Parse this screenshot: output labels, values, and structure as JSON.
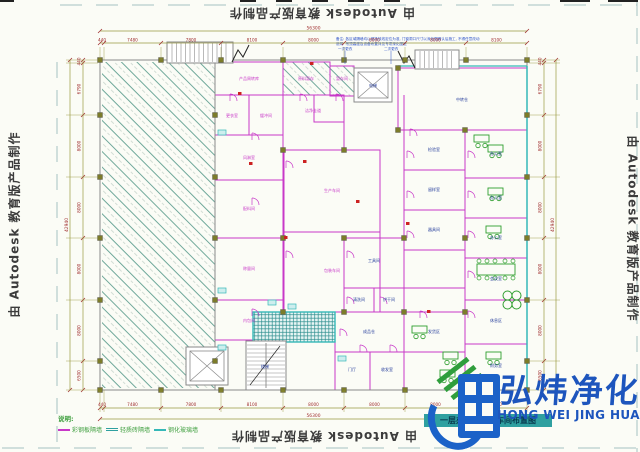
{
  "watermark": {
    "text": "由 Autodesk 教育版产品制作"
  },
  "legend": {
    "title": "说明:",
    "items": [
      "彩钢板隔墙",
      "轻质砖隔墙",
      "钢化玻璃墙"
    ]
  },
  "title_bar": {
    "text": "一层办公及生产车间布置图"
  },
  "logo": {
    "cn": "弘炜净化",
    "en": "HONG WEI JING HUA"
  },
  "note": {
    "lines": [
      "备注: 各区域隔墙均以现场放线定位为准, 门窗洞口尺寸以深化图确认后施工, 不得任意改动",
      "说明: 吊顶高度及设备布置详见专项深化图纸"
    ],
    "callouts": [
      {
        "t": "一次更衣",
        "x": 338,
        "y": 50
      },
      {
        "t": "二次更衣",
        "x": 384,
        "y": 50
      }
    ]
  },
  "dims": {
    "xticks": [
      100,
      104,
      161,
      221,
      283,
      344,
      405,
      466,
      527
    ],
    "yticks": [
      60,
      63,
      115,
      177,
      238,
      300,
      361,
      390
    ],
    "top": {
      "total": "56300",
      "labels": [
        "440",
        "7480",
        "7800",
        "8100",
        "8000",
        "8000",
        "8000",
        "8100"
      ]
    },
    "bottom": {
      "total": "56300",
      "labels": [
        "440",
        "7480",
        "7800",
        "8100",
        "8000",
        "8000",
        "8000",
        "8100"
      ]
    },
    "left": {
      "total": "42940",
      "labels": [
        "440",
        "6790",
        "8000",
        "8000",
        "8000",
        "8000",
        "6500"
      ]
    },
    "right": {
      "total": "42940",
      "labels": [
        "440",
        "6790",
        "8000",
        "8000",
        "8000",
        "8000",
        "6500"
      ]
    }
  },
  "plan": {
    "outline": [
      100,
      60,
      427,
      330
    ],
    "hall_hatch": [
      102,
      62,
      113,
      326
    ],
    "rooms": [
      [
        215,
        62,
        68,
        33,
        "m",
        ""
      ],
      [
        215,
        95,
        34,
        40,
        "m",
        ""
      ],
      [
        249,
        95,
        34,
        40,
        "m",
        ""
      ],
      [
        215,
        135,
        68,
        45,
        "m",
        ""
      ],
      [
        215,
        180,
        68,
        58,
        "m",
        ""
      ],
      [
        215,
        238,
        68,
        62,
        "m",
        ""
      ],
      [
        215,
        300,
        68,
        40,
        "m",
        ""
      ],
      [
        283,
        62,
        47,
        33,
        "m",
        "h"
      ],
      [
        330,
        66,
        24,
        30,
        "m",
        "h"
      ],
      [
        283,
        95,
        61,
        55,
        "m",
        ""
      ],
      [
        314,
        95,
        30,
        27,
        "m",
        ""
      ],
      [
        284,
        150,
        96,
        82,
        "m",
        ""
      ],
      [
        284,
        232,
        96,
        80,
        "m",
        ""
      ],
      [
        398,
        68,
        129,
        62,
        "m",
        ""
      ],
      [
        344,
        238,
        60,
        50,
        "m",
        ""
      ],
      [
        344,
        288,
        30,
        24,
        "m",
        ""
      ],
      [
        374,
        288,
        30,
        24,
        "m",
        ""
      ],
      [
        404,
        130,
        61,
        40,
        "m",
        ""
      ],
      [
        404,
        170,
        61,
        40,
        "m",
        ""
      ],
      [
        404,
        210,
        61,
        40,
        "m",
        ""
      ],
      [
        404,
        250,
        61,
        38,
        "m",
        ""
      ],
      [
        465,
        130,
        62,
        48,
        "m",
        ""
      ],
      [
        465,
        178,
        62,
        40,
        "m",
        ""
      ],
      [
        465,
        218,
        62,
        40,
        "m",
        ""
      ],
      [
        465,
        258,
        62,
        42,
        "m",
        ""
      ],
      [
        465,
        300,
        62,
        44,
        "m",
        ""
      ],
      [
        465,
        344,
        62,
        46,
        "m",
        ""
      ],
      [
        335,
        312,
        69,
        40,
        "m",
        ""
      ],
      [
        335,
        352,
        35,
        38,
        "m",
        ""
      ],
      [
        370,
        352,
        34,
        38,
        "m",
        ""
      ],
      [
        404,
        312,
        61,
        40,
        "m",
        ""
      ],
      [
        404,
        352,
        61,
        38,
        "m",
        ""
      ],
      [
        253,
        312,
        82,
        30,
        "c",
        "x"
      ]
    ],
    "lines": [
      [
        100,
        60,
        527,
        60,
        "g",
        1
      ],
      [
        100,
        390,
        527,
        390,
        "g",
        1
      ],
      [
        100,
        60,
        100,
        390,
        "g",
        1
      ],
      [
        215,
        60,
        215,
        390,
        "g",
        1
      ],
      [
        527,
        66,
        527,
        390,
        "c",
        1.5
      ],
      [
        398,
        66,
        527,
        66,
        "c",
        1.2
      ],
      [
        283,
        62,
        283,
        95,
        "m",
        1
      ],
      [
        283,
        95,
        283,
        150,
        "m",
        1
      ],
      [
        380,
        150,
        380,
        312,
        "m",
        1
      ],
      [
        404,
        95,
        404,
        130,
        "m",
        1
      ],
      [
        404,
        288,
        404,
        312,
        "m",
        1
      ]
    ],
    "labels": [
      [
        "产品周转库",
        249,
        80,
        "m"
      ],
      [
        "原料暂存",
        306,
        80,
        "m"
      ],
      [
        "暂存间",
        342,
        80,
        "m"
      ],
      [
        "中转仓",
        462,
        101,
        "n"
      ],
      [
        "更衣室",
        232,
        117,
        "m"
      ],
      [
        "缓冲间",
        266,
        117,
        "m"
      ],
      [
        "风淋室",
        249,
        159,
        "m"
      ],
      [
        "洁净走道",
        313,
        112,
        "m"
      ],
      [
        "配料间",
        249,
        210,
        "m"
      ],
      [
        "生产车间",
        332,
        192,
        "m"
      ],
      [
        "包装车间",
        332,
        272,
        "m"
      ],
      [
        "称量间",
        249,
        270,
        "m"
      ],
      [
        "内包间",
        249,
        322,
        "m"
      ],
      [
        "检验室",
        434,
        151,
        "n"
      ],
      [
        "留样室",
        434,
        191,
        "n"
      ],
      [
        "器具间",
        434,
        231,
        "n"
      ],
      [
        "工具间",
        374,
        262,
        "n"
      ],
      [
        "清洗间",
        359,
        301,
        "n"
      ],
      [
        "烘干间",
        389,
        301,
        "n"
      ],
      [
        "办公室",
        496,
        155,
        "n"
      ],
      [
        "办公室",
        496,
        199,
        "n"
      ],
      [
        "办公室",
        496,
        239,
        "n"
      ],
      [
        "会议室",
        496,
        280,
        "n"
      ],
      [
        "休息区",
        496,
        322,
        "n"
      ],
      [
        "财务室",
        496,
        367,
        "n"
      ],
      [
        "成品仓",
        369,
        333,
        "n"
      ],
      [
        "发货区",
        434,
        333,
        "n"
      ],
      [
        "门厅",
        352,
        371,
        "n"
      ],
      [
        "收发室",
        387,
        371,
        "n"
      ],
      [
        "电梯",
        373,
        87,
        "n"
      ],
      [
        "楼梯",
        265,
        368,
        "n"
      ]
    ],
    "stairs": {
      "a": [
        167,
        42,
        66,
        21
      ],
      "b": [
        415,
        50,
        44,
        19
      ],
      "c": [
        246,
        341,
        40,
        49
      ]
    },
    "elevators": [
      [
        354,
        68,
        38,
        34
      ],
      [
        186,
        347,
        42,
        38
      ]
    ],
    "columns_extra": [
      [
        283,
        150
      ],
      [
        344,
        150
      ],
      [
        283,
        238
      ],
      [
        344,
        238
      ],
      [
        283,
        312
      ],
      [
        344,
        312
      ],
      [
        404,
        238
      ],
      [
        404,
        312
      ],
      [
        465,
        238
      ],
      [
        465,
        130
      ],
      [
        398,
        130
      ],
      [
        465,
        312
      ],
      [
        398,
        68
      ]
    ],
    "arcs": [
      [
        252,
        140
      ],
      [
        252,
        205
      ],
      [
        286,
        168
      ],
      [
        286,
        258
      ],
      [
        347,
        258
      ],
      [
        407,
        158
      ],
      [
        407,
        198
      ],
      [
        407,
        238
      ],
      [
        468,
        158
      ],
      [
        468,
        198
      ],
      [
        468,
        238
      ],
      [
        468,
        278
      ],
      [
        468,
        318
      ],
      [
        347,
        304
      ],
      [
        380,
        304
      ],
      [
        420,
        318
      ],
      [
        340,
        336
      ],
      [
        300,
        101
      ],
      [
        336,
        101
      ],
      [
        410,
        136
      ],
      [
        252,
        316
      ],
      [
        230,
        101
      ],
      [
        360,
        352
      ],
      [
        390,
        352
      ]
    ],
    "desks": [
      [
        488,
        145
      ],
      [
        488,
        188
      ],
      [
        486,
        226
      ],
      [
        486,
        352
      ],
      [
        443,
        352
      ],
      [
        412,
        326
      ],
      [
        440,
        370
      ],
      [
        474,
        135
      ]
    ],
    "table": [
      477,
      264
    ],
    "clover": [
      512,
      300
    ],
    "fixtures": [
      [
        218,
        130
      ],
      [
        218,
        288
      ],
      [
        288,
        304
      ],
      [
        338,
        356
      ],
      [
        218,
        345
      ],
      [
        268,
        300
      ]
    ],
    "reds": [
      [
        284,
        236
      ],
      [
        303,
        160
      ],
      [
        427,
        310
      ],
      [
        356,
        200
      ],
      [
        249,
        162
      ],
      [
        406,
        222
      ],
      [
        238,
        92
      ],
      [
        310,
        62
      ]
    ]
  }
}
